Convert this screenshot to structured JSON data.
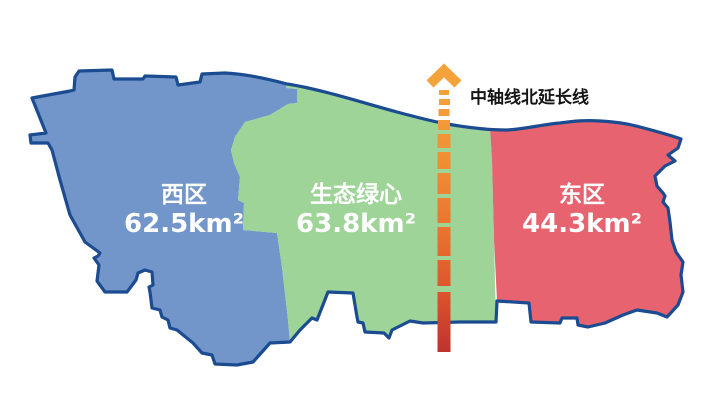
{
  "page": {
    "background": "#FFFFFF",
    "description_label": "urban sub-center district map"
  },
  "map": {
    "outline_color": "#1B4B90",
    "label_text_color": "#FFFFFF",
    "regions": [
      {
        "key": "west",
        "name": "西区",
        "area_label": "62.5km²",
        "area_km2": 62.5,
        "fill": "#7296CA"
      },
      {
        "key": "green-heart",
        "name": "生态绿心",
        "area_label": "63.8km²",
        "area_km2": 63.8,
        "fill": "#9ED497"
      },
      {
        "key": "east",
        "name": "东区",
        "area_label": "44.3km²",
        "area_km2": 44.3,
        "fill": "#E76370"
      }
    ]
  },
  "axis": {
    "label": "中轴线北延长线",
    "label_color": "#151515",
    "stop_colors": [
      "#F4A33B",
      "#EF8C35",
      "#E9722F",
      "#DC532C",
      "#BE332E"
    ]
  }
}
